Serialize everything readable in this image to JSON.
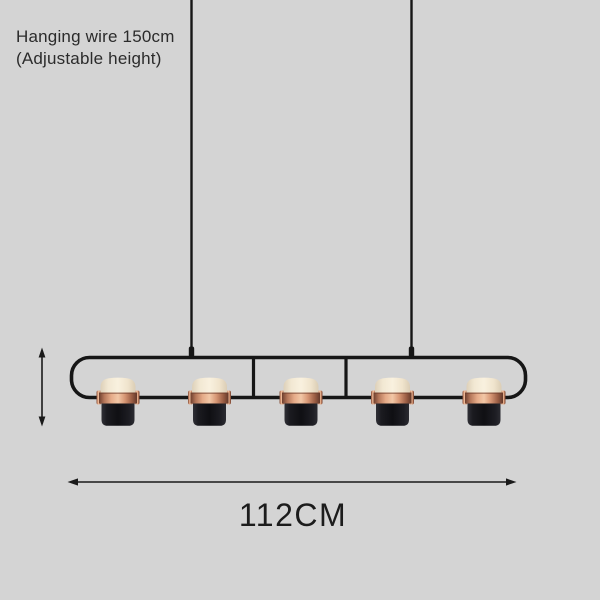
{
  "page": {
    "background_color": "#d4d4d4",
    "description": "Product dimension diagram of a black linear pendant lamp with five cylindrical LED heads"
  },
  "annotations": {
    "hanging_wire_note_line1": "Hanging wire 150cm",
    "hanging_wire_note_line2": "(Adjustable height)",
    "width_label": "112CM"
  },
  "fixture": {
    "lamp_count": 5,
    "colors": {
      "frame": "#161616",
      "copper_band": "#d69674",
      "shade_glow": "#f7efdd",
      "lamp_body": "#131317",
      "annotation_text": "#2b2b2b"
    }
  }
}
